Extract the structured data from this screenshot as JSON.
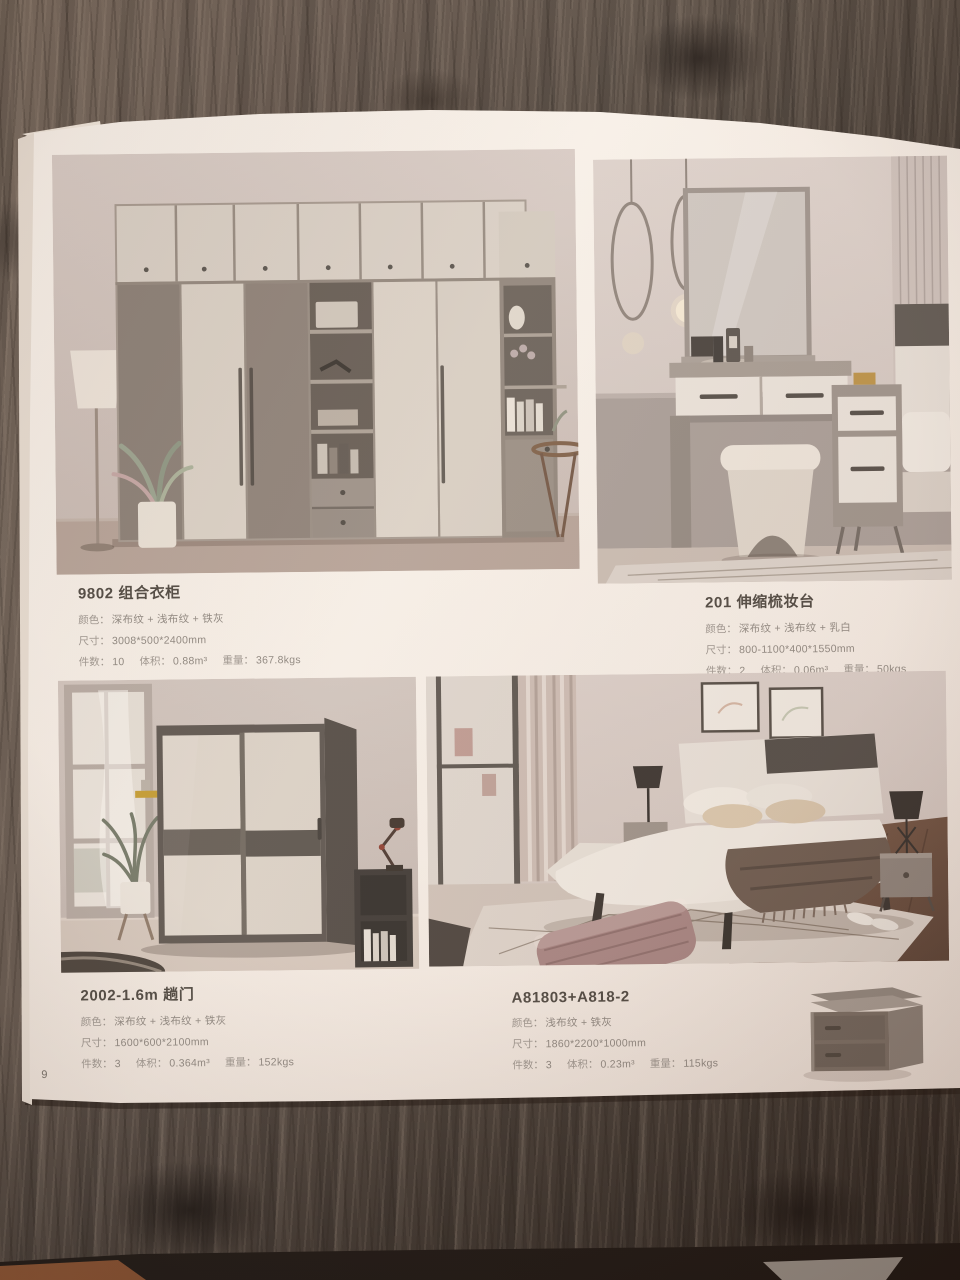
{
  "page": {
    "number": "9"
  },
  "products": [
    {
      "model": "9802 组合衣柜",
      "color_label": "颜色：",
      "color": "深布纹 + 浅布纹 + 铁灰",
      "size_label": "尺寸：",
      "size": "3008*500*2400mm",
      "qty_label": "件数：",
      "qty": "10",
      "volume_label": "体积：",
      "volume": "0.88m³",
      "weight_label": "重量：",
      "weight": "367.8kgs"
    },
    {
      "model": "201 伸缩梳妆台",
      "color_label": "颜色：",
      "color": "深布纹 + 浅布纹 + 乳白",
      "size_label": "尺寸：",
      "size": "800-1100*400*1550mm",
      "qty_label": "件数：",
      "qty": "2",
      "volume_label": "体积：",
      "volume": "0.06m³",
      "weight_label": "重量：",
      "weight": "50kgs"
    },
    {
      "model": "2002-1.6m 趟门",
      "color_label": "颜色：",
      "color": "深布纹 + 浅布纹 + 铁灰",
      "size_label": "尺寸：",
      "size": "1600*600*2100mm",
      "qty_label": "件数：",
      "qty": "3",
      "volume_label": "体积：",
      "volume": "0.364m³",
      "weight_label": "重量：",
      "weight": "152kgs"
    },
    {
      "model": "A81803+A818-2",
      "color_label": "颜色：",
      "color": "浅布纹 + 铁灰",
      "size_label": "尺寸：",
      "size": "1860*2200*1000mm",
      "qty_label": "件数：",
      "qty": "3",
      "volume_label": "体积：",
      "volume": "0.23m³",
      "weight_label": "重量：",
      "weight": "115kgs"
    }
  ]
}
